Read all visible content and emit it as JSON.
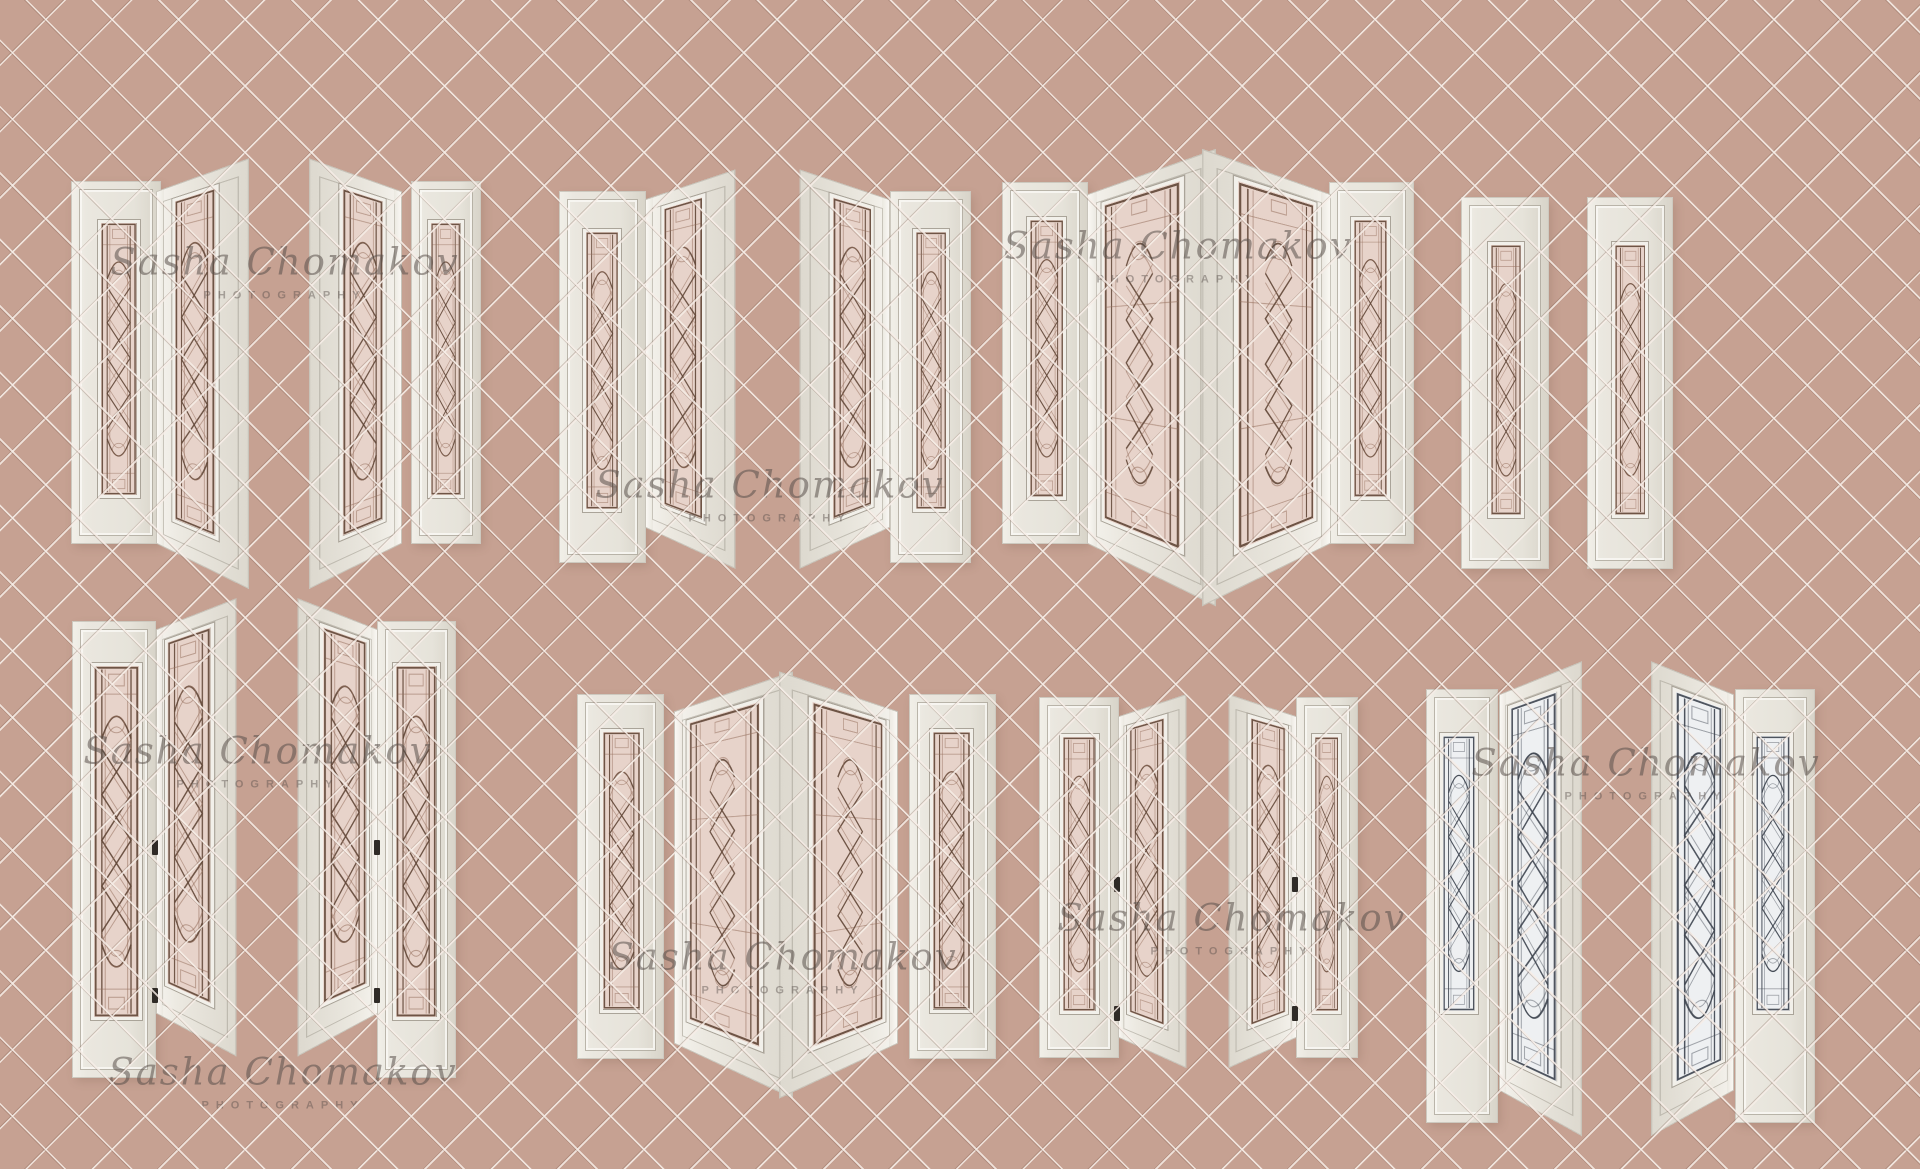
{
  "canvas": {
    "width": 1920,
    "height": 1169,
    "background": "#c6a192",
    "grid_pitch_px": 47,
    "grid_line_light": "#f6ede7",
    "grid_line_dark": "#7d5f50"
  },
  "watermark": {
    "line1": "Sasha Chomakov",
    "line2": "PHOTOGRAPHY",
    "color": "#5a504c",
    "instances": [
      {
        "x": 285,
        "y": 256
      },
      {
        "x": 770,
        "y": 479
      },
      {
        "x": 1178,
        "y": 240
      },
      {
        "x": 258,
        "y": 745
      },
      {
        "x": 283,
        "y": 1066
      },
      {
        "x": 783,
        "y": 951
      },
      {
        "x": 1232,
        "y": 912
      },
      {
        "x": 1646,
        "y": 757
      }
    ]
  },
  "palette": {
    "door_face": "#eae7df",
    "door_face_shade": "#d9d5cb",
    "door_edge": "#f8f6f1",
    "molding_line": "#a8a397",
    "glass_pink": "#e7d3ca",
    "glass_bright": "#eef0f2",
    "lead_dark": "#60463a",
    "lead_bright": "#3c4450",
    "hinge": "#2f2b27"
  },
  "panels": [
    {
      "name": "t1-sidelite",
      "kind": "flat",
      "x": 72,
      "y": 182,
      "w": 88,
      "h": 361,
      "glass": {
        "l": 30,
        "r": 23,
        "t": 10.5,
        "b": 12.5
      },
      "tint": "pink",
      "pattern": "narrow"
    },
    {
      "name": "t1-door-open",
      "kind": "open",
      "hinge": "left",
      "x": 157,
      "y": 192,
      "w": 86,
      "h": 351,
      "glass": {
        "l": 20,
        "r": 28,
        "t": 3.5,
        "b": 8
      },
      "tint": "pink",
      "pattern": "narrow"
    },
    {
      "name": "t2-door-open",
      "kind": "open",
      "hinge": "right",
      "x": 315,
      "y": 192,
      "w": 86,
      "h": 351,
      "glass": {
        "l": 28,
        "r": 20,
        "t": 3.5,
        "b": 8
      },
      "tint": "pink",
      "pattern": "narrow"
    },
    {
      "name": "t2-sidelite",
      "kind": "flat",
      "x": 412,
      "y": 182,
      "w": 68,
      "h": 361,
      "glass": {
        "l": 24,
        "r": 24,
        "t": 10.5,
        "b": 12.5
      },
      "tint": "pink",
      "pattern": "narrow"
    },
    {
      "name": "t3-door-flat",
      "kind": "flat",
      "x": 560,
      "y": 192,
      "w": 85,
      "h": 370,
      "glass": {
        "l": 27,
        "r": 28,
        "t": 10,
        "b": 13.5
      },
      "tint": "pink",
      "pattern": "narrow"
    },
    {
      "name": "t3-door-open",
      "kind": "open",
      "hinge": "left",
      "x": 646,
      "y": 200,
      "w": 84,
      "h": 327,
      "glass": {
        "l": 20,
        "r": 28,
        "t": 3.5,
        "b": 8
      },
      "tint": "pink",
      "pattern": "narrow"
    },
    {
      "name": "t4-door-open",
      "kind": "open",
      "hinge": "right",
      "x": 805,
      "y": 200,
      "w": 84,
      "h": 327,
      "glass": {
        "l": 28,
        "r": 20,
        "t": 3.5,
        "b": 8
      },
      "tint": "pink",
      "pattern": "narrow"
    },
    {
      "name": "t4-door-flat",
      "kind": "flat",
      "x": 891,
      "y": 192,
      "w": 79,
      "h": 370,
      "glass": {
        "l": 28,
        "r": 26,
        "t": 10,
        "b": 13.5
      },
      "tint": "pink",
      "pattern": "narrow"
    },
    {
      "name": "t5-door-flat",
      "kind": "flat",
      "x": 1003,
      "y": 183,
      "w": 84,
      "h": 360,
      "glass": {
        "l": 28,
        "r": 25,
        "t": 9.5,
        "b": 12
      },
      "tint": "pink",
      "pattern": "narrow"
    },
    {
      "name": "t5-door-open",
      "kind": "open",
      "hinge": "left",
      "x": 1088,
      "y": 195,
      "w": 112,
      "h": 348,
      "glass": {
        "l": 13,
        "r": 20,
        "t": 3.5,
        "b": 8
      },
      "tint": "pink",
      "pattern": "wide"
    },
    {
      "name": "t6-door-open",
      "kind": "open",
      "hinge": "right",
      "x": 1218,
      "y": 195,
      "w": 112,
      "h": 348,
      "glass": {
        "l": 20,
        "r": 13,
        "t": 3.5,
        "b": 8
      },
      "tint": "pink",
      "pattern": "wide"
    },
    {
      "name": "t6-door-flat",
      "kind": "flat",
      "x": 1330,
      "y": 183,
      "w": 83,
      "h": 360,
      "glass": {
        "l": 25,
        "r": 28,
        "t": 9.5,
        "b": 12
      },
      "tint": "pink",
      "pattern": "narrow"
    },
    {
      "name": "t7-sidelite",
      "kind": "flat",
      "x": 1462,
      "y": 198,
      "w": 86,
      "h": 370,
      "glass": {
        "l": 30,
        "r": 28,
        "t": 12,
        "b": 13.5
      },
      "tint": "pink",
      "pattern": "narrow"
    },
    {
      "name": "t8-sidelite",
      "kind": "flat",
      "x": 1588,
      "y": 198,
      "w": 84,
      "h": 370,
      "glass": {
        "l": 28,
        "r": 28,
        "t": 12,
        "b": 13.5
      },
      "tint": "pink",
      "pattern": "narrow"
    },
    {
      "name": "b1-door-flat",
      "kind": "flat",
      "x": 73,
      "y": 622,
      "w": 82,
      "h": 455,
      "glass": {
        "l": 22,
        "r": 16,
        "t": 9,
        "b": 12.5
      },
      "tint": "pink",
      "pattern": "narrow"
    },
    {
      "name": "b1-door-open",
      "kind": "open",
      "hinge": "left",
      "x": 157,
      "y": 630,
      "w": 76,
      "h": 383,
      "glass": {
        "l": 12,
        "r": 24,
        "t": 3.5,
        "b": 8
      },
      "tint": "pink",
      "pattern": "narrow"
    },
    {
      "name": "b2-door-open",
      "kind": "open",
      "hinge": "right",
      "x": 301,
      "y": 630,
      "w": 76,
      "h": 383,
      "glass": {
        "l": 24,
        "r": 12,
        "t": 3.5,
        "b": 8
      },
      "tint": "pink",
      "pattern": "narrow"
    },
    {
      "name": "b2-door-flat",
      "kind": "flat",
      "x": 378,
      "y": 622,
      "w": 77,
      "h": 455,
      "glass": {
        "l": 20,
        "r": 20,
        "t": 9,
        "b": 12.5
      },
      "tint": "pink",
      "pattern": "narrow"
    },
    {
      "name": "b3-sidelite-left",
      "kind": "flat",
      "x": 578,
      "y": 695,
      "w": 85,
      "h": 363,
      "glass": {
        "l": 26,
        "r": 23,
        "t": 9.5,
        "b": 12.5
      },
      "tint": "pink",
      "pattern": "narrow"
    },
    {
      "name": "b3-door-open-left",
      "kind": "open",
      "hinge": "left",
      "x": 675,
      "y": 712,
      "w": 105,
      "h": 331,
      "glass": {
        "l": 12,
        "r": 20,
        "t": 3.5,
        "b": 8
      },
      "tint": "pink",
      "pattern": "wide"
    },
    {
      "name": "b3-door-open-right",
      "kind": "open",
      "hinge": "right",
      "x": 792,
      "y": 712,
      "w": 105,
      "h": 331,
      "glass": {
        "l": 20,
        "r": 12,
        "t": 3.5,
        "b": 8
      },
      "tint": "pink",
      "pattern": "wide"
    },
    {
      "name": "b3-sidelite-right",
      "kind": "flat",
      "x": 910,
      "y": 695,
      "w": 85,
      "h": 363,
      "glass": {
        "l": 23,
        "r": 26,
        "t": 9.5,
        "b": 12.5
      },
      "tint": "pink",
      "pattern": "narrow"
    },
    {
      "name": "b4-door-flat",
      "kind": "flat",
      "x": 1040,
      "y": 698,
      "w": 78,
      "h": 359,
      "glass": {
        "l": 26,
        "r": 25,
        "t": 10,
        "b": 12
      },
      "tint": "pink",
      "pattern": "narrow"
    },
    {
      "name": "b4-door-open",
      "kind": "open",
      "hinge": "left",
      "x": 1119,
      "y": 717,
      "w": 66,
      "h": 320,
      "glass": {
        "l": 14,
        "r": 24,
        "t": 3.5,
        "b": 8
      },
      "tint": "pink",
      "pattern": "narrow"
    },
    {
      "name": "b5-door-open",
      "kind": "open",
      "hinge": "right",
      "x": 1230,
      "y": 717,
      "w": 66,
      "h": 320,
      "glass": {
        "l": 24,
        "r": 14,
        "t": 3.5,
        "b": 8
      },
      "tint": "pink",
      "pattern": "narrow"
    },
    {
      "name": "b5-door-flat",
      "kind": "flat",
      "x": 1297,
      "y": 698,
      "w": 60,
      "h": 359,
      "glass": {
        "l": 25,
        "r": 26,
        "t": 10,
        "b": 12
      },
      "tint": "pink",
      "pattern": "narrow"
    },
    {
      "name": "b6-sidelite",
      "kind": "flat",
      "x": 1427,
      "y": 690,
      "w": 70,
      "h": 432,
      "glass": {
        "l": 19,
        "r": 27,
        "t": 10,
        "b": 25
      },
      "tint": "bright",
      "pattern": "narrow"
    },
    {
      "name": "b6-door-open",
      "kind": "open",
      "hinge": "left",
      "x": 1500,
      "y": 695,
      "w": 78,
      "h": 395,
      "glass": {
        "l": 12,
        "r": 22,
        "t": 3.5,
        "b": 8
      },
      "tint": "bright",
      "pattern": "narrow"
    },
    {
      "name": "b7-door-open",
      "kind": "open",
      "hinge": "right",
      "x": 1655,
      "y": 695,
      "w": 78,
      "h": 395,
      "glass": {
        "l": 22,
        "r": 12,
        "t": 3.5,
        "b": 8
      },
      "tint": "bright",
      "pattern": "narrow"
    },
    {
      "name": "b7-sidelite",
      "kind": "flat",
      "x": 1736,
      "y": 690,
      "w": 78,
      "h": 432,
      "glass": {
        "l": 22,
        "r": 27,
        "t": 10,
        "b": 25
      },
      "tint": "bright",
      "pattern": "narrow"
    }
  ],
  "hinges": [
    {
      "x": 152,
      "y": 840
    },
    {
      "x": 152,
      "y": 988
    },
    {
      "x": 374,
      "y": 840
    },
    {
      "x": 374,
      "y": 988
    },
    {
      "x": 1114,
      "y": 877
    },
    {
      "x": 1114,
      "y": 1006
    },
    {
      "x": 1292,
      "y": 877
    },
    {
      "x": 1292,
      "y": 1006
    }
  ]
}
